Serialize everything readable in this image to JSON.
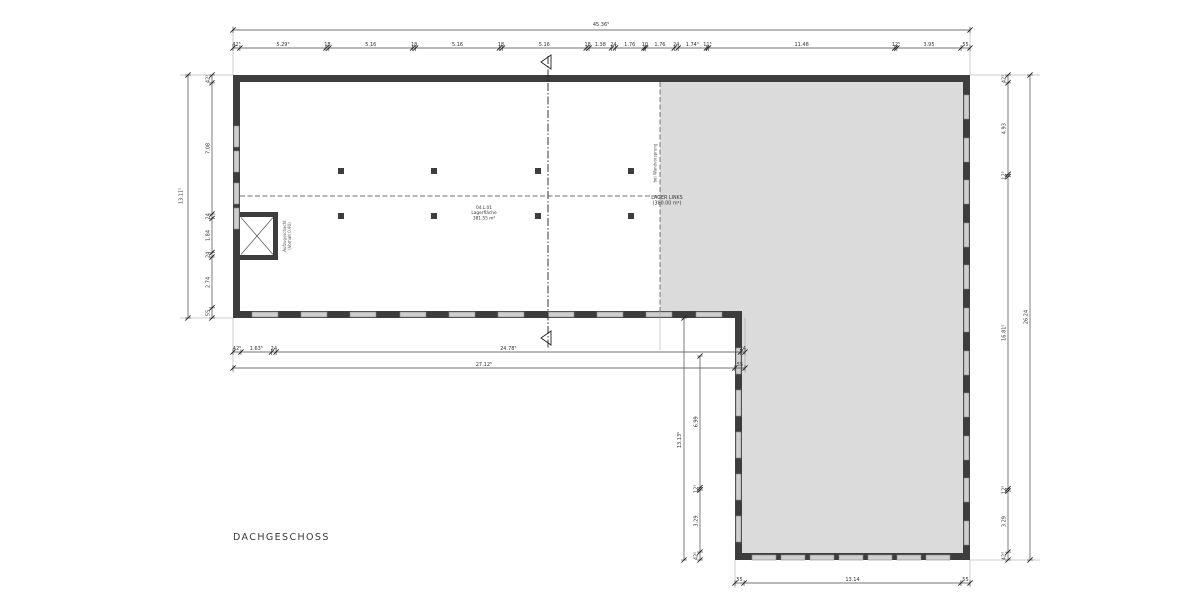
{
  "title": "DACHGESCHOSS",
  "colors": {
    "wall": "#3d3d3d",
    "area_fill": "#dbdbdb",
    "window_fill": "#cfcfcf",
    "window_stroke": "#888888",
    "dim_line": "#444444",
    "text": "#333333"
  },
  "rooms": {
    "main": {
      "line1": "04.L.01",
      "line2": "Lagerfläche",
      "line3": "381.55 m²"
    },
    "lager": {
      "line1": "LAGER LINKS",
      "line2": "(380.00 m²)"
    },
    "shaft": {
      "line1": "Aufzugsschacht",
      "line2": "(Vorhalt 0.90)"
    }
  },
  "notes": {
    "boundary": "bei Wandvorsprung"
  },
  "dims": {
    "top_total": "45.36⁵",
    "left_total": "13.11⁵",
    "right_total": "26.24",
    "inner_b_total": "13.13⁵",
    "top": [
      {
        "t": "42⁵",
        "v": 0.425
      },
      {
        "t": "5.29⁵",
        "v": 5.295
      },
      {
        "t": "18",
        "v": 0.18
      },
      {
        "t": "5.16",
        "v": 5.16
      },
      {
        "t": "18",
        "v": 0.18
      },
      {
        "t": "5.16",
        "v": 5.16
      },
      {
        "t": "18",
        "v": 0.18
      },
      {
        "t": "5.16",
        "v": 5.16
      },
      {
        "t": "18",
        "v": 0.18
      },
      {
        "t": "1.38",
        "v": 1.38
      },
      {
        "t": "24",
        "v": 0.24
      },
      {
        "t": "1.76",
        "v": 1.76
      },
      {
        "t": "10",
        "v": 0.1
      },
      {
        "t": "1.76",
        "v": 1.76
      },
      {
        "t": "24",
        "v": 0.24
      },
      {
        "t": "1.74⁵",
        "v": 1.745
      },
      {
        "t": "11⁵",
        "v": 0.115
      },
      {
        "t": "11.48",
        "v": 11.48
      },
      {
        "t": "12⁵",
        "v": 0.125
      },
      {
        "t": "3.95",
        "v": 3.95
      },
      {
        "t": "55",
        "v": 0.55
      }
    ],
    "left": [
      {
        "t": "42⁵",
        "v": 0.425
      },
      {
        "t": "7.08",
        "v": 7.08
      },
      {
        "t": "24",
        "v": 0.24
      },
      {
        "t": "1.84",
        "v": 1.84
      },
      {
        "t": "24",
        "v": 0.24
      },
      {
        "t": "2.74",
        "v": 2.74
      },
      {
        "t": "55",
        "v": 0.55
      }
    ],
    "right": [
      {
        "t": "42⁵",
        "v": 0.425
      },
      {
        "t": "4.93",
        "v": 4.93
      },
      {
        "t": "12⁵",
        "v": 0.125
      },
      {
        "t": "16.81⁵",
        "v": 16.815
      },
      {
        "t": "12⁵",
        "v": 0.125
      },
      {
        "t": "3.29",
        "v": 3.29
      },
      {
        "t": "42⁵",
        "v": 0.425
      }
    ],
    "bottom_left_row1": [
      {
        "t": "42⁵",
        "v": 0.425
      },
      {
        "t": "1.63⁵",
        "v": 1.635
      },
      {
        "t": "24",
        "v": 0.24
      },
      {
        "t": "24.78⁵",
        "v": 24.785
      },
      {
        "t": "24",
        "v": 0.24
      }
    ],
    "bottom_left_row2": [
      {
        "t": "27.12⁵",
        "v": 27.125
      },
      {
        "t": "55",
        "v": 0.55
      }
    ],
    "inner_a": [
      {
        "t": "6.99",
        "v": 6.99
      },
      {
        "t": "12⁵",
        "v": 0.125
      },
      {
        "t": "3.29",
        "v": 3.29
      },
      {
        "t": "42⁵",
        "v": 0.425
      }
    ],
    "bottom": [
      {
        "t": "55",
        "v": 0.55
      },
      {
        "t": "13.14",
        "v": 13.14
      },
      {
        "t": "55",
        "v": 0.55
      }
    ]
  }
}
